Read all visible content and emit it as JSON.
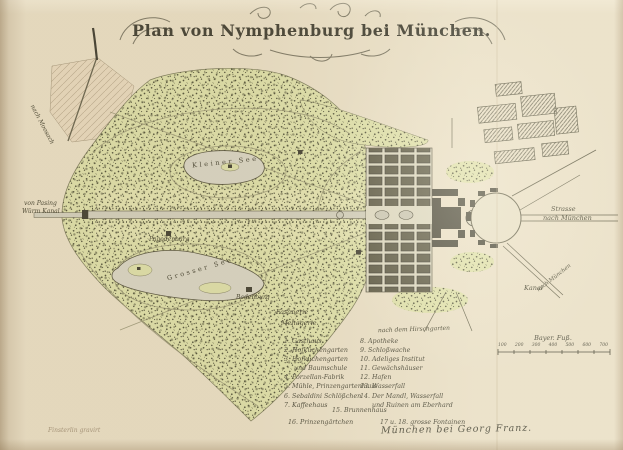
{
  "title": "Plan von Nymphenburg bei München.",
  "map_labels": {
    "kleiner_see": "Kleiner See",
    "grosser_see": "Grosser See",
    "pagodenburg": "Pagodenburg",
    "badenburg": "Badenburg",
    "fasanerie": "Fasanerie",
    "menagerie": "Menagerie",
    "von_pasing": "von Pasing",
    "wuerm_kanal": "Würm Kanal",
    "strasse": "Strasse",
    "nach_muenchen": "nach München",
    "kanal": "Kanal",
    "nach_dem_hirschgarten": "nach dem Hirschgarten",
    "nach_moosach": "nach Moosach",
    "strasse_diagonal": "nach München"
  },
  "legend": {
    "left_column": [
      "1. Gasthaus",
      "2. Hofküchengarten",
      "3. Hofküchengarten",
      "     und Baumschule",
      "4. Porzellan-Fabrik",
      "5. Mühle, Prinzengartenhaus",
      "6. Sebaldini Schlößchen",
      "7. Kaffeehaus"
    ],
    "right_column": [
      "8. Apotheke",
      "9. Schloßwache",
      "10. Adeliges Institut",
      "11. Gewächshäuser",
      "12. Hafen",
      "13. Wasserfall",
      "14. Der Mandl, Wasserfall",
      "      und Ruinen am Eberhard"
    ],
    "item_15": "15. Brunnenhaus",
    "item_16": "16. Prinzengärtchen",
    "item_17_18": "17 u. 18. grosse Fontainen"
  },
  "scale_bar": {
    "title": "Bayer. Fuß.",
    "tick_labels": [
      "100",
      "200",
      "300",
      "400",
      "500",
      "600",
      "700"
    ]
  },
  "imprint": "München bei Georg Franz.",
  "engraver_credit": "Finsterlin gravirt",
  "colors": {
    "paper": "#e9dfc6",
    "park_green": "#dce0a6",
    "water": "#d6d4c4",
    "ink": "#32311f"
  }
}
